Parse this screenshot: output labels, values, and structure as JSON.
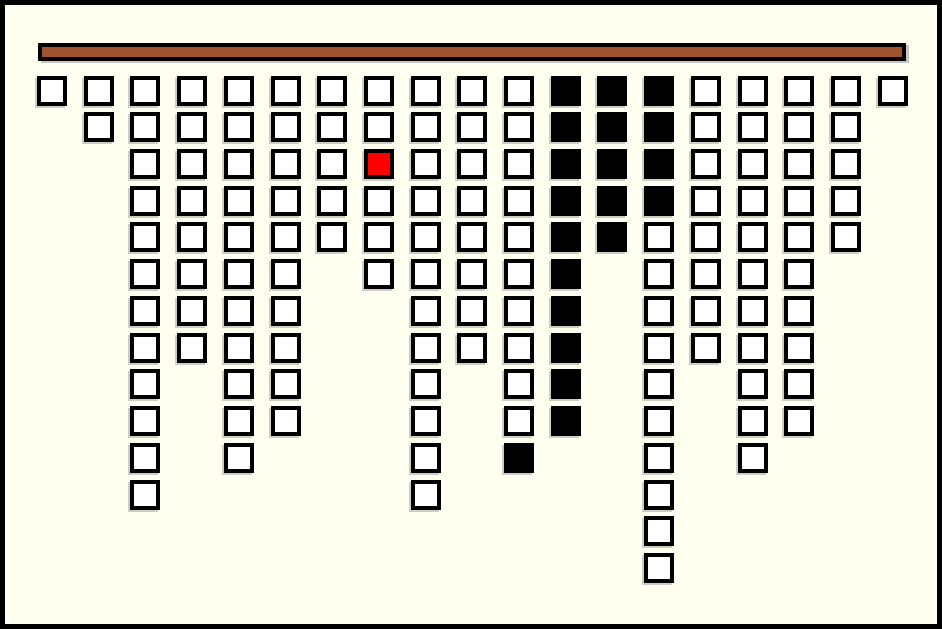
{
  "board": {
    "description": "icicle-style game board: columns of squares hanging from a wooden bar",
    "columns_count": 19,
    "rows_max": 14,
    "total_cells": 150
  },
  "colors": {
    "background": "#FFFFF0",
    "frame": "#000000",
    "bar_fill": "#A0522D",
    "bar_border": "#000000",
    "cell_border": "#000000",
    "cell_white": "#FFFFFF",
    "cell_black": "#000000",
    "cell_red": "#FF0000"
  },
  "grid": {
    "legend": {
      "W": "white cell",
      "B": "black cell",
      "R": "red highlighted cell"
    },
    "columns": [
      [
        "W"
      ],
      [
        "W",
        "W"
      ],
      [
        "W",
        "W",
        "W",
        "W",
        "W",
        "W",
        "W",
        "W",
        "W",
        "W",
        "W",
        "W"
      ],
      [
        "W",
        "W",
        "W",
        "W",
        "W",
        "W",
        "W",
        "W"
      ],
      [
        "W",
        "W",
        "W",
        "W",
        "W",
        "W",
        "W",
        "W",
        "W",
        "W",
        "W"
      ],
      [
        "W",
        "W",
        "W",
        "W",
        "W",
        "W",
        "W",
        "W",
        "W",
        "W"
      ],
      [
        "W",
        "W",
        "W",
        "W",
        "W"
      ],
      [
        "W",
        "W",
        "R",
        "W",
        "W",
        "W"
      ],
      [
        "W",
        "W",
        "W",
        "W",
        "W",
        "W",
        "W",
        "W",
        "W",
        "W",
        "W",
        "W"
      ],
      [
        "W",
        "W",
        "W",
        "W",
        "W",
        "W",
        "W",
        "W"
      ],
      [
        "W",
        "W",
        "W",
        "W",
        "W",
        "W",
        "W",
        "W",
        "W",
        "W",
        "B"
      ],
      [
        "B",
        "B",
        "B",
        "B",
        "B",
        "B",
        "B",
        "B",
        "B",
        "B"
      ],
      [
        "B",
        "B",
        "B",
        "B",
        "B"
      ],
      [
        "B",
        "B",
        "B",
        "B",
        "W",
        "W",
        "W",
        "W",
        "W",
        "W",
        "W",
        "W",
        "W",
        "W"
      ],
      [
        "W",
        "W",
        "W",
        "W",
        "W",
        "W",
        "W",
        "W"
      ],
      [
        "W",
        "W",
        "W",
        "W",
        "W",
        "W",
        "W",
        "W",
        "W",
        "W",
        "W"
      ],
      [
        "W",
        "W",
        "W",
        "W",
        "W",
        "W",
        "W",
        "W",
        "W",
        "W"
      ],
      [
        "W",
        "W",
        "W",
        "W",
        "W"
      ],
      [
        "W"
      ]
    ]
  },
  "layout_metrics": {
    "first_col_x": 32,
    "col_spacing": 46.7,
    "first_row_y": 70.5,
    "row_spacing": 36.73
  }
}
